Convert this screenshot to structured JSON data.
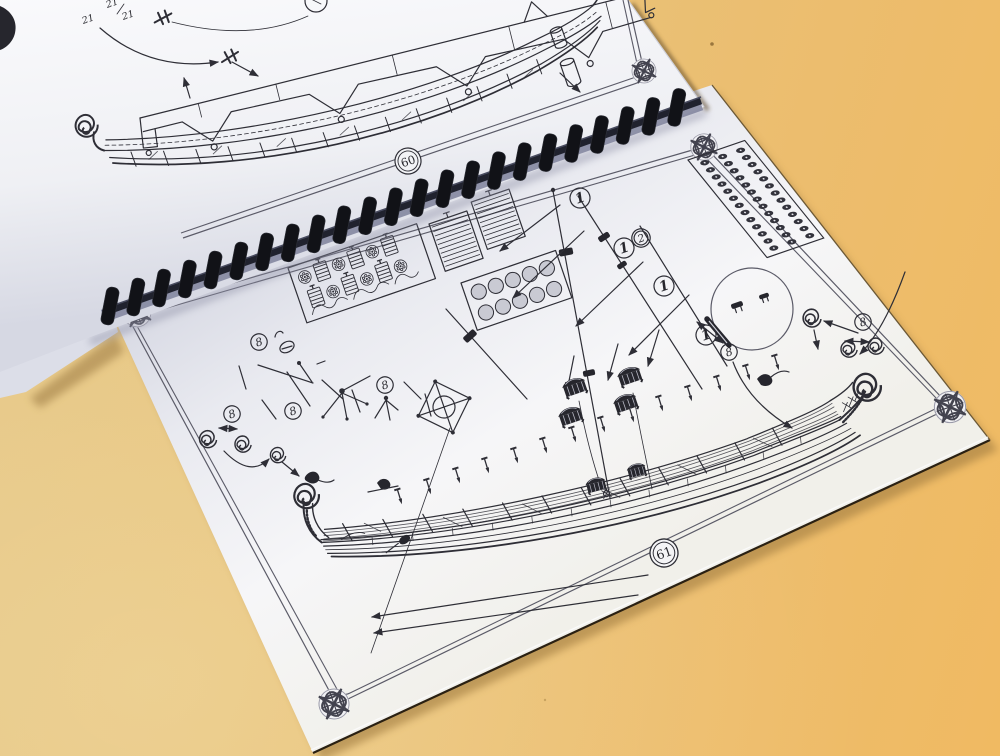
{
  "scene": {
    "description": "photo of an open comb-bound model-ship instruction booklet on an orange table",
    "table_color": "#ecbd6e",
    "paper_color": "#f4f4f6",
    "ink_color": "#2e2e36",
    "border_color": "#5b5b68",
    "binding_color": "#14141a"
  },
  "top_page": {
    "page_number": "60",
    "part_labels": [
      "21",
      "21",
      "21"
    ],
    "drawing": "viking-longship-hull-on-building-slip"
  },
  "bottom_page": {
    "page_number": "61",
    "fittings_panel_label": "2",
    "spar_markers": [
      "1",
      "1",
      "1",
      "1"
    ],
    "part_markers": [
      "8",
      "8",
      "8",
      "8",
      "8",
      "8"
    ],
    "drawing": "viking-longship-deck-fittings-and-mast-stepping"
  }
}
